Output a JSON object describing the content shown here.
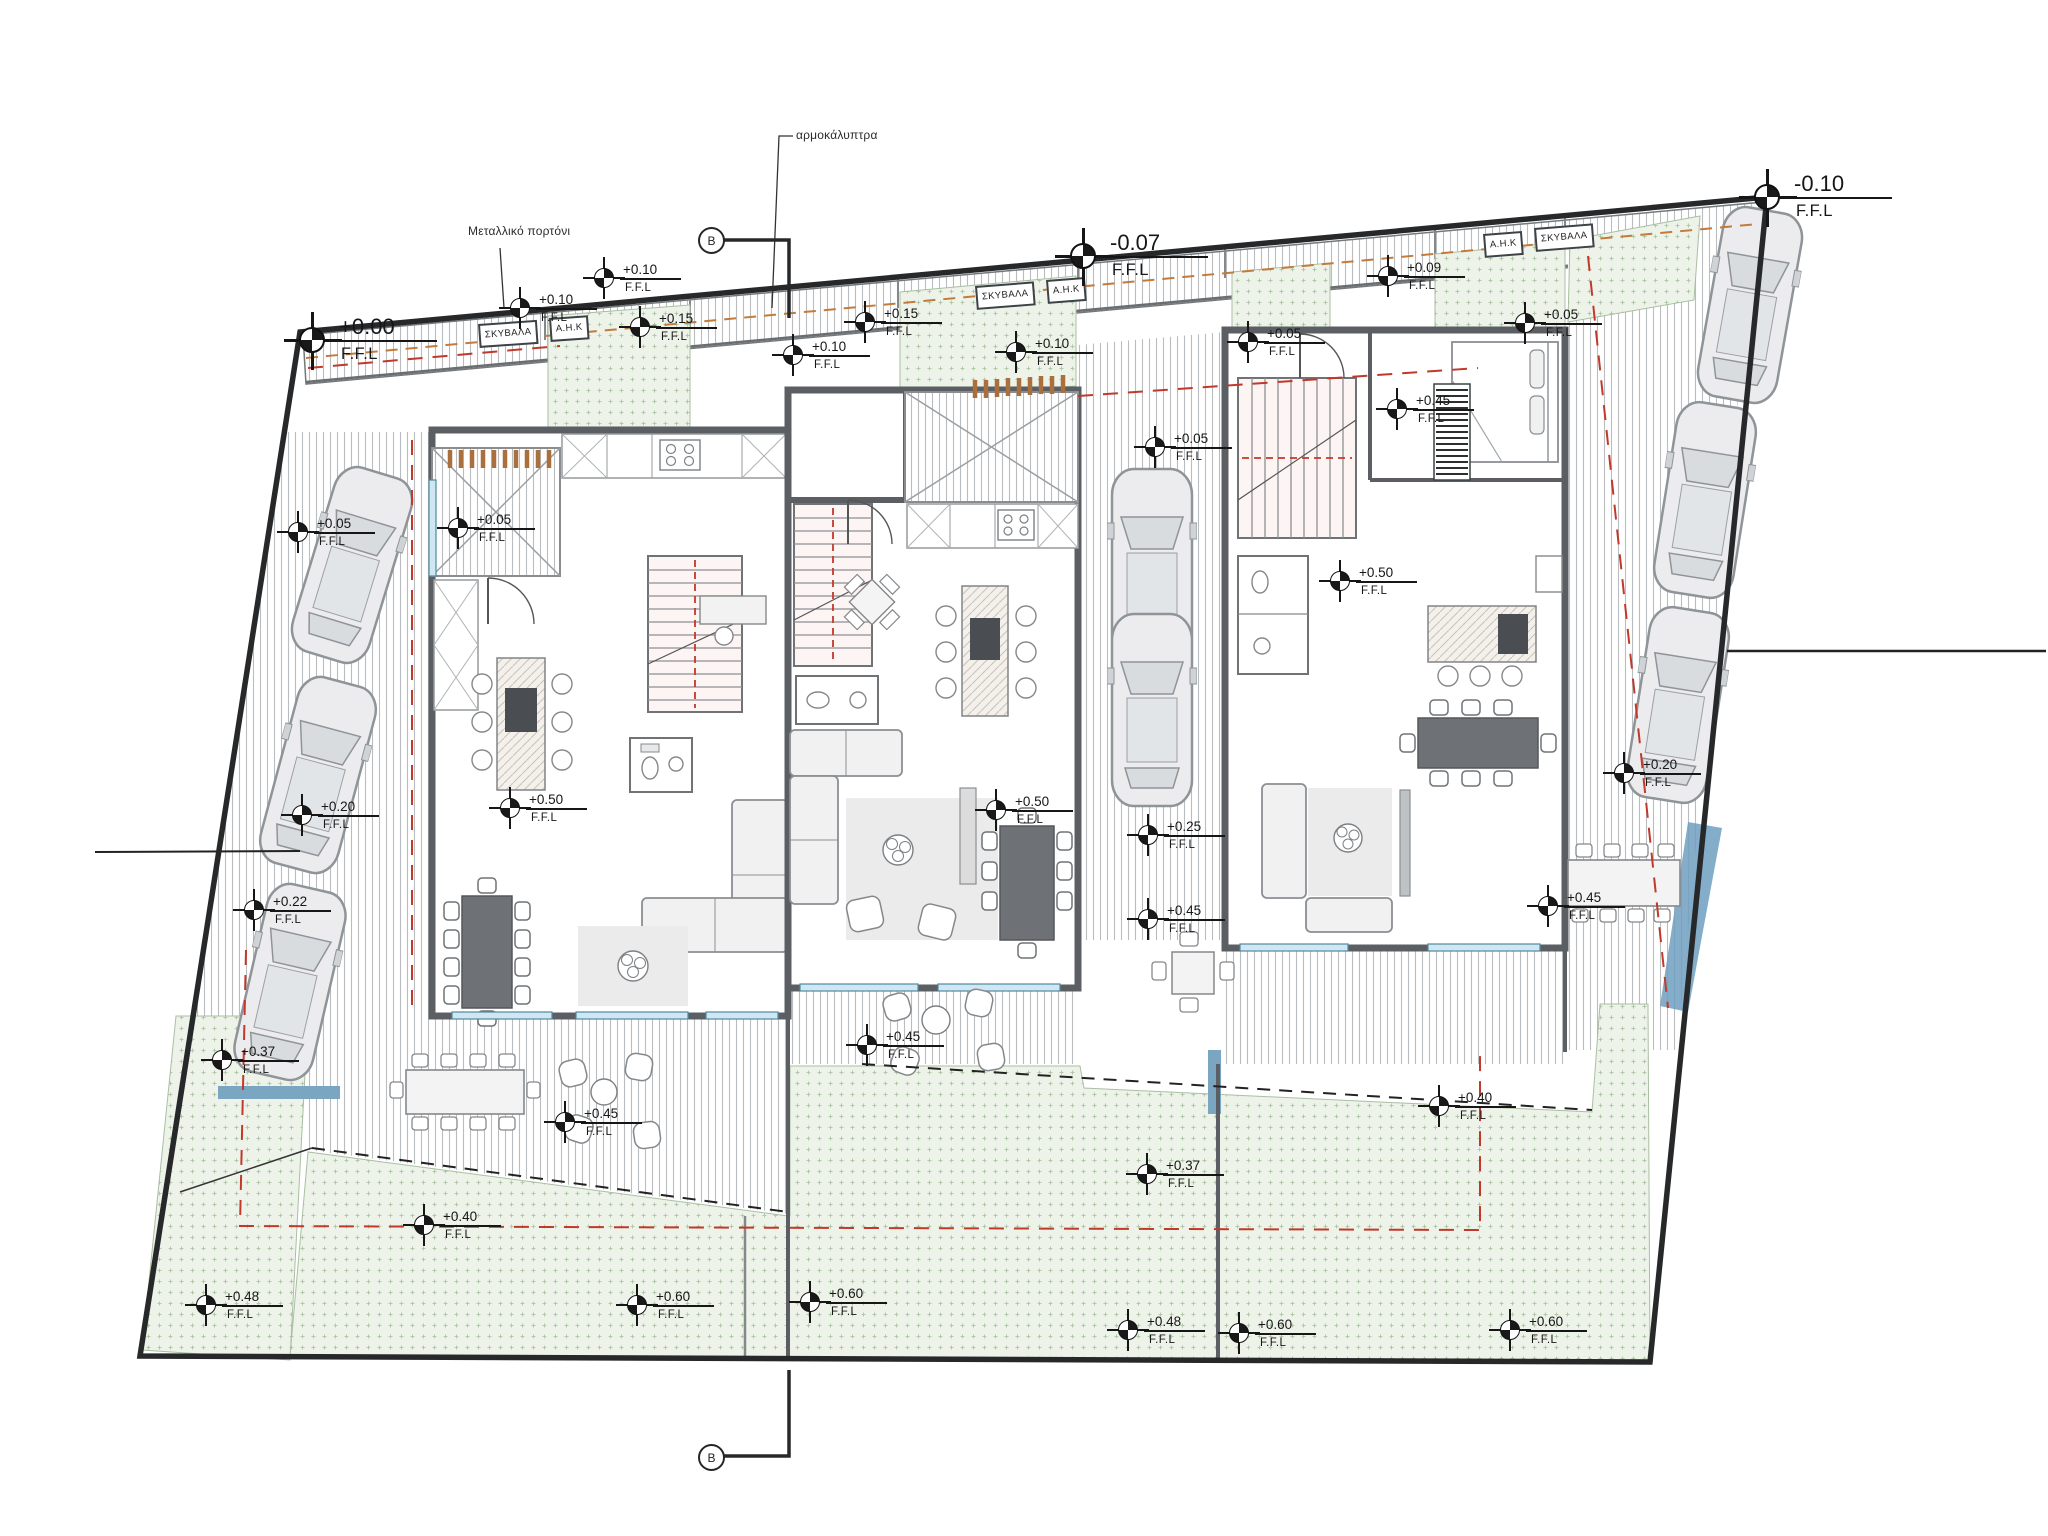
{
  "plan": {
    "level_suffix": "F.F.L",
    "survey_markers": [
      {
        "value": "+0.00",
        "x": 312,
        "y": 340
      },
      {
        "value": "-0.07",
        "x": 1083,
        "y": 256
      },
      {
        "value": "-0.10",
        "x": 1767,
        "y": 197
      }
    ],
    "spot_levels": [
      {
        "value": "+0.10",
        "x": 604,
        "y": 278
      },
      {
        "value": "+0.10",
        "x": 520,
        "y": 308
      },
      {
        "value": "+0.15",
        "x": 640,
        "y": 327
      },
      {
        "value": "+0.15",
        "x": 865,
        "y": 322
      },
      {
        "value": "+0.10",
        "x": 793,
        "y": 355
      },
      {
        "value": "+0.10",
        "x": 1016,
        "y": 352
      },
      {
        "value": "+0.09",
        "x": 1388,
        "y": 276
      },
      {
        "value": "+0.05",
        "x": 1248,
        "y": 342
      },
      {
        "value": "+0.05",
        "x": 1525,
        "y": 323
      },
      {
        "value": "+0.05",
        "x": 298,
        "y": 532
      },
      {
        "value": "+0.05",
        "x": 458,
        "y": 528
      },
      {
        "value": "+0.05",
        "x": 1155,
        "y": 447
      },
      {
        "value": "+0.50",
        "x": 510,
        "y": 808
      },
      {
        "value": "+0.50",
        "x": 996,
        "y": 810
      },
      {
        "value": "+0.50",
        "x": 1340,
        "y": 581
      },
      {
        "value": "+0.45",
        "x": 1397,
        "y": 409
      },
      {
        "value": "+0.25",
        "x": 1148,
        "y": 835
      },
      {
        "value": "+0.20",
        "x": 302,
        "y": 815
      },
      {
        "value": "+0.22",
        "x": 254,
        "y": 910
      },
      {
        "value": "+0.37",
        "x": 222,
        "y": 1060
      },
      {
        "value": "+0.45",
        "x": 565,
        "y": 1122
      },
      {
        "value": "+0.45",
        "x": 867,
        "y": 1045
      },
      {
        "value": "+0.45",
        "x": 1148,
        "y": 919
      },
      {
        "value": "+0.20",
        "x": 1624,
        "y": 773
      },
      {
        "value": "+0.45",
        "x": 1548,
        "y": 906
      },
      {
        "value": "+0.37",
        "x": 1147,
        "y": 1174
      },
      {
        "value": "+0.40",
        "x": 424,
        "y": 1225
      },
      {
        "value": "+0.40",
        "x": 1439,
        "y": 1106
      },
      {
        "value": "+0.48",
        "x": 206,
        "y": 1305
      },
      {
        "value": "+0.60",
        "x": 637,
        "y": 1305
      },
      {
        "value": "+0.60",
        "x": 810,
        "y": 1302
      },
      {
        "value": "+0.48",
        "x": 1128,
        "y": 1330
      },
      {
        "value": "+0.60",
        "x": 1239,
        "y": 1333
      },
      {
        "value": "+0.60",
        "x": 1510,
        "y": 1330
      }
    ],
    "utility_boxes": [
      {
        "text": "ΣΚΥΒΑΛΑ",
        "x": 478,
        "y": 324,
        "rot": -4
      },
      {
        "text": "Α.Η.Κ",
        "x": 549,
        "y": 318,
        "rot": -4
      },
      {
        "text": "ΣΚΥΒΑΛΑ",
        "x": 975,
        "y": 286,
        "rot": -4.5
      },
      {
        "text": "Α.Η.Κ",
        "x": 1046,
        "y": 280,
        "rot": -4.5
      },
      {
        "text": "Α.Η.Κ",
        "x": 1483,
        "y": 234,
        "rot": -4.5
      },
      {
        "text": "ΣΚΥΒΑΛΑ",
        "x": 1534,
        "y": 228,
        "rot": -4.5
      }
    ],
    "annotations": [
      {
        "text": "αρμοκάλυπτρα",
        "x": 796,
        "y": 128
      },
      {
        "text": "Μεταλλικό πορτόνι",
        "x": 468,
        "y": 224
      }
    ],
    "sections": [
      {
        "letter": "B",
        "x": 711,
        "y": 240
      },
      {
        "letter": "B",
        "x": 711,
        "y": 1457
      }
    ]
  },
  "colors": {
    "boundary": "#26282a",
    "wall": "#5b5f63",
    "window": "#cfe7f2",
    "garden": "#eef3ea",
    "setback_red": "#c0392b",
    "pergola_orange": "#a96f3c",
    "water_blue": "#6f9fc0"
  }
}
